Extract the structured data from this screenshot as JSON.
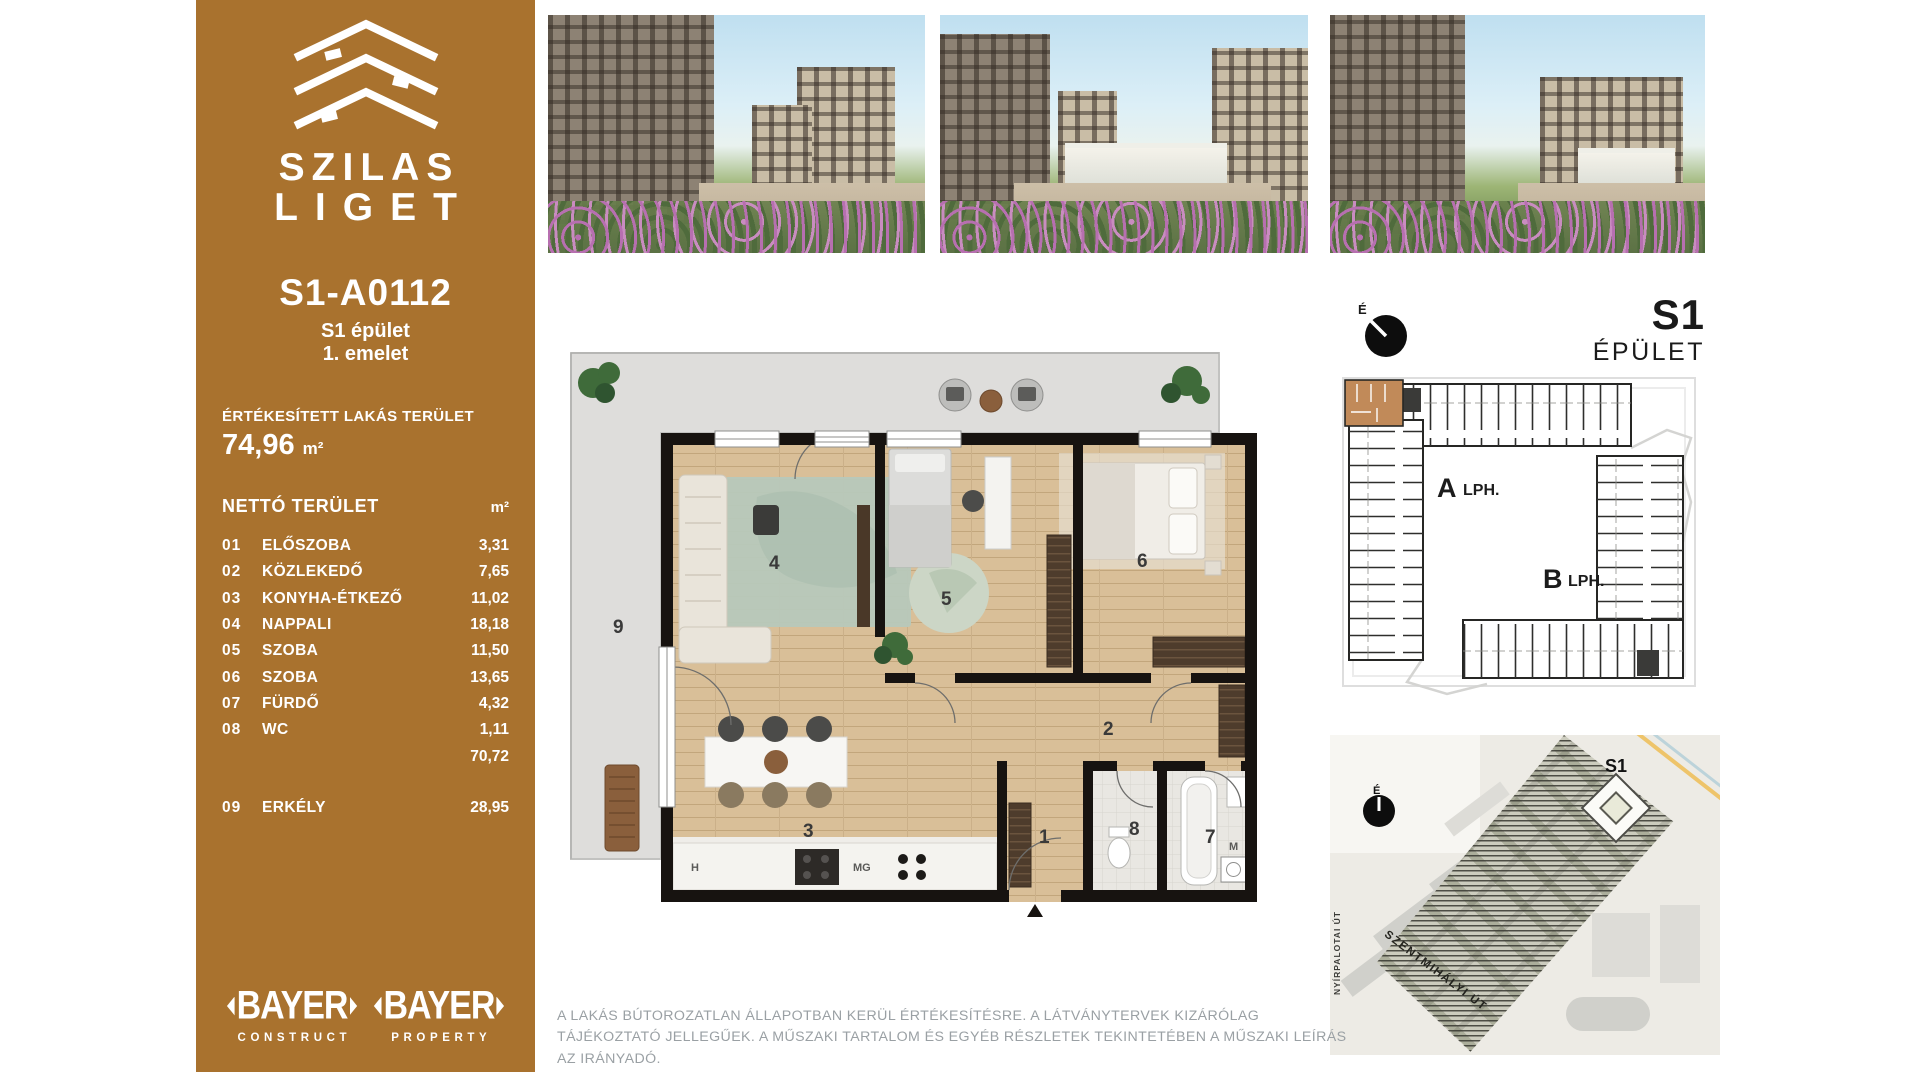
{
  "colors": {
    "brand_brown": "#a9722e",
    "unit_highlight": "#c18a59",
    "wall_black": "#171310",
    "wood": "#d9bf98",
    "terrace_gray": "#dedddb",
    "rug_sage": "#b7c8ba",
    "disclaimer_gray": "#9aa0a4"
  },
  "sidebar": {
    "brand_line1": "SZILAS",
    "brand_line2": "LIGET",
    "apartment_code": "S1-A0112",
    "building": "S1 épület",
    "floor": "1. emelet",
    "sold_area_label": "ÉRTÉKESÍTETT LAKÁS TERÜLET",
    "sold_area_value": "74,96",
    "sold_area_unit": "m²",
    "net_area_label": "NETTÓ TERÜLET",
    "net_area_unit": "m²",
    "rooms": [
      {
        "no": "01",
        "name": "ELŐSZOBA",
        "area": "3,31"
      },
      {
        "no": "02",
        "name": "KÖZLEKEDŐ",
        "area": "7,65"
      },
      {
        "no": "03",
        "name": "KONYHA-ÉTKEZŐ",
        "area": "11,02"
      },
      {
        "no": "04",
        "name": "NAPPALI",
        "area": "18,18"
      },
      {
        "no": "05",
        "name": "SZOBA",
        "area": "11,50"
      },
      {
        "no": "06",
        "name": "SZOBA",
        "area": "13,65"
      },
      {
        "no": "07",
        "name": "FÜRDŐ",
        "area": "4,32"
      },
      {
        "no": "08",
        "name": "WC",
        "area": "1,11"
      }
    ],
    "net_total": "70,72",
    "balcony": {
      "no": "09",
      "name": "ERKÉLY",
      "area": "28,95"
    },
    "logo1": {
      "brand": "BAYER",
      "sub": "CONSTRUCT"
    },
    "logo2": {
      "brand": "BAYER",
      "sub": "PROPERTY"
    }
  },
  "plan": {
    "labels": {
      "r1": "1",
      "r2": "2",
      "r3": "3",
      "r4": "4",
      "r5": "5",
      "r6": "6",
      "r7": "7",
      "r8": "8",
      "r9": "9",
      "h": "H",
      "mg": "MG",
      "m": "M"
    }
  },
  "right_panel": {
    "north_label": "É",
    "building_code": "S1",
    "building_label": "ÉPÜLET",
    "keyplan": {
      "stair_a": "A",
      "stair_a_sub": "LPH.",
      "stair_b": "B",
      "stair_b_sub": "LPH."
    },
    "sitemap": {
      "north_label": "É",
      "building_tag": "S1",
      "street1": "NYÍRPALOTAI ÚT",
      "street2": "SZENTMIHÁLYI ÚT"
    }
  },
  "disclaimer": "A LAKÁS BÚTOROZATLAN ÁLLAPOTBAN KERÜL ÉRTÉKESÍTÉSRE. A LÁTVÁNYTERVEK KIZÁRÓLAG TÁJÉKOZTATÓ JELLEGŰEK. A MŰSZAKI TARTALOM ÉS EGYÉB RÉSZLETEK TEKINTETÉBEN A MŰSZAKI LEÍRÁS AZ IRÁNYADÓ."
}
